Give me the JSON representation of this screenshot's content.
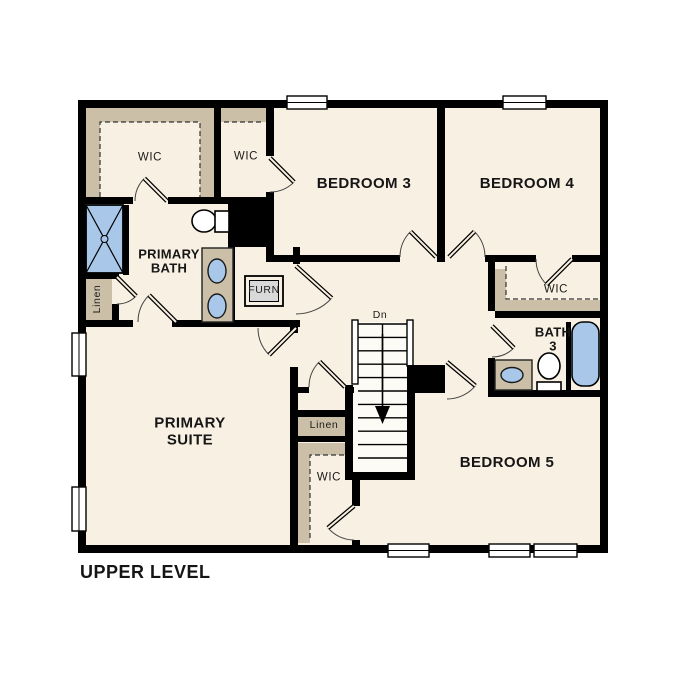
{
  "title": "UPPER LEVEL",
  "colors": {
    "floor": "#f8f0e2",
    "outside": "#ffffff",
    "wall": "#000000",
    "closet_band": "#cbbfa8",
    "fixture_blue": "#a9c8e9",
    "fixture_outline": "#1a1a1a",
    "stair_fill": "#fdfbf5",
    "furn_fill": "#d9d9d9",
    "window_fill": "#ffffff"
  },
  "rooms": {
    "wic_primary": "WIC",
    "wic_bed3": "WIC",
    "bedroom3": "BEDROOM 3",
    "bedroom4": "BEDROOM 4",
    "primary_bath_line1": "PRIMARY",
    "primary_bath_line2": "BATH",
    "furnace": "FURN",
    "linen_left": "Linen",
    "primary_suite_line1": "PRIMARY",
    "primary_suite_line2": "SUITE",
    "stairs_direction": "Dn",
    "linen_hall": "Linen",
    "wic_hall": "WIC",
    "wic_bed4": "WIC",
    "bath3_line1": "BATH",
    "bath3_line2": "3",
    "bedroom5": "BEDROOM 5"
  }
}
